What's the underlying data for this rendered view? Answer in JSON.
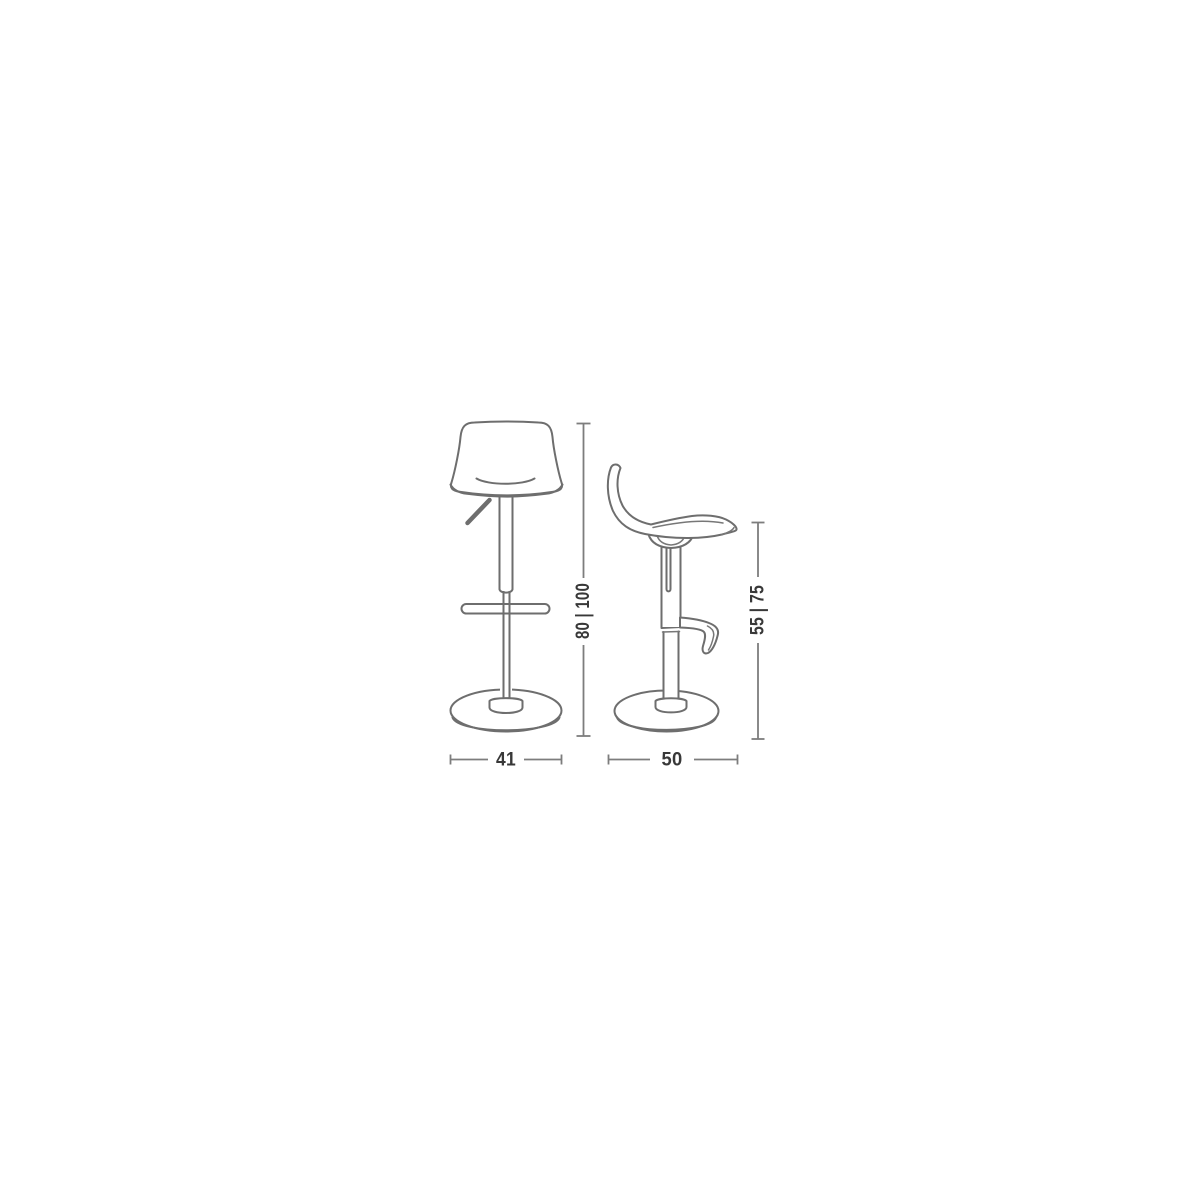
{
  "diagram": {
    "title": "bar stool dimension drawing",
    "subject": "height-adjustable swivel bar stool with backrest, gas-lift column, footrest and round base",
    "views": {
      "front": {
        "name": "front view"
      },
      "side": {
        "name": "side view"
      }
    },
    "dimensions": {
      "overall_height": "80 | 100",
      "seat_height": "55 | 75",
      "width": "41",
      "depth": "50"
    },
    "colors": {
      "background": "#ffffff",
      "line": "#6e6e6e",
      "dimension_line": "#7d7d7d",
      "label_text": "#383838"
    }
  }
}
